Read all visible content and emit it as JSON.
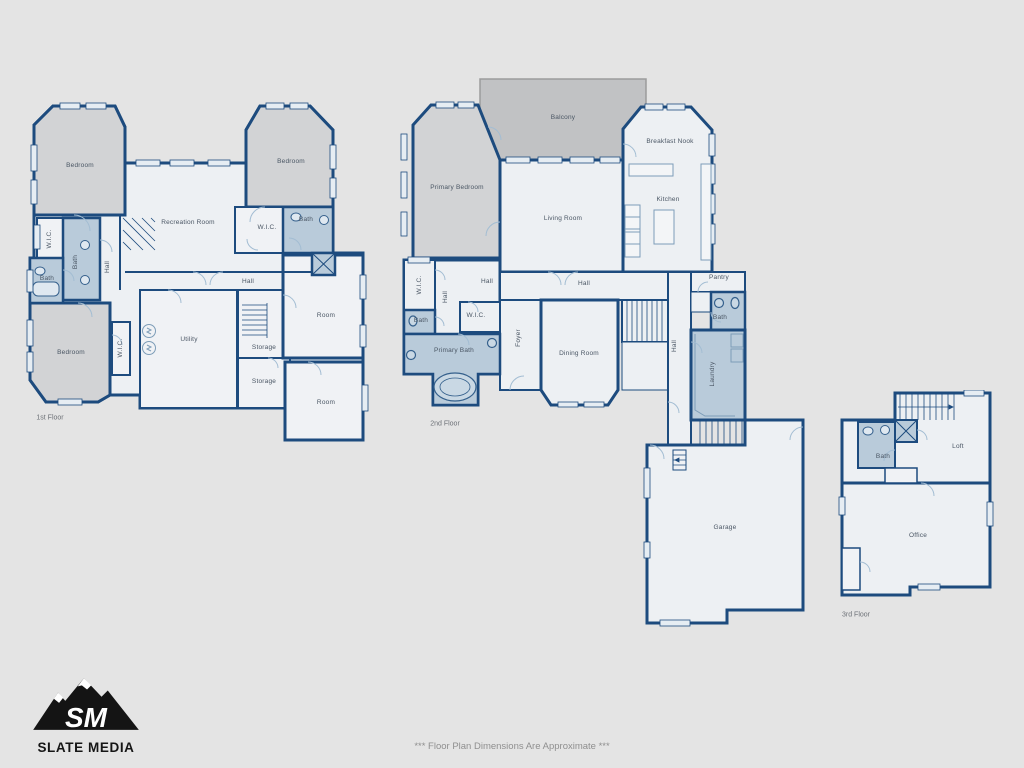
{
  "page": {
    "background": "#e4e4e4",
    "footer_note": "*** Floor Plan Dimensions Are Approximate ***"
  },
  "branding": {
    "monogram": "SM",
    "company": "SLATE MEDIA"
  },
  "palette": {
    "wall": "#1d4b7e",
    "room_fill": "#edf0f3",
    "bedroom_gray": "#d2d3d5",
    "balcony_gray": "#c1c2c4",
    "wet_room_blue": "#b9cbda",
    "door_arc": "#a3bdd3",
    "window_fill": "#e6edf3",
    "label_color": "#4a5664"
  },
  "floors": [
    {
      "name": "1st Floor",
      "rooms": [
        {
          "id": "bedroom-nw",
          "label": "Bedroom"
        },
        {
          "id": "recreation-room",
          "label": "Recreation Room"
        },
        {
          "id": "bedroom-ne",
          "label": "Bedroom"
        },
        {
          "id": "wic-ne",
          "label": "W.I.C."
        },
        {
          "id": "bath-ne",
          "label": "Bath"
        },
        {
          "id": "wic-w",
          "label": "W.I.C."
        },
        {
          "id": "bath-w",
          "label": "Bath"
        },
        {
          "id": "hall-w",
          "label": "Hall"
        },
        {
          "id": "bath-sw",
          "label": "Bath"
        },
        {
          "id": "bedroom-sw",
          "label": "Bedroom"
        },
        {
          "id": "wic-sw",
          "label": "W.I.C."
        },
        {
          "id": "utility",
          "label": "Utility"
        },
        {
          "id": "hall-center",
          "label": "Hall"
        },
        {
          "id": "storage-upper",
          "label": "Storage"
        },
        {
          "id": "storage-lower",
          "label": "Storage"
        },
        {
          "id": "room-east-upper",
          "label": "Room"
        },
        {
          "id": "room-east-lower",
          "label": "Room"
        }
      ]
    },
    {
      "name": "2nd Floor",
      "rooms": [
        {
          "id": "balcony",
          "label": "Balcony"
        },
        {
          "id": "primary-bedroom",
          "label": "Primary Bedroom"
        },
        {
          "id": "living-room",
          "label": "Living Room"
        },
        {
          "id": "breakfast-nook",
          "label": "Breakfast Nook"
        },
        {
          "id": "kitchen",
          "label": "Kitchen"
        },
        {
          "id": "wic-nw",
          "label": "W.I.C."
        },
        {
          "id": "hall-w",
          "label": "Hall"
        },
        {
          "id": "hall-small",
          "label": "Hall"
        },
        {
          "id": "wic-center",
          "label": "W.I.C."
        },
        {
          "id": "bath-w",
          "label": "Bath"
        },
        {
          "id": "primary-bath",
          "label": "Primary Bath"
        },
        {
          "id": "foyer",
          "label": "Foyer"
        },
        {
          "id": "hall-center",
          "label": "Hall"
        },
        {
          "id": "dining-room",
          "label": "Dining Room"
        },
        {
          "id": "pantry",
          "label": "Pantry"
        },
        {
          "id": "bath-e",
          "label": "Bath"
        },
        {
          "id": "hall-e",
          "label": "Hall"
        },
        {
          "id": "laundry",
          "label": "Laundry"
        },
        {
          "id": "garage",
          "label": "Garage"
        }
      ]
    },
    {
      "name": "3rd Floor",
      "rooms": [
        {
          "id": "bath",
          "label": "Bath"
        },
        {
          "id": "loft",
          "label": "Loft"
        },
        {
          "id": "office",
          "label": "Office"
        }
      ]
    }
  ]
}
